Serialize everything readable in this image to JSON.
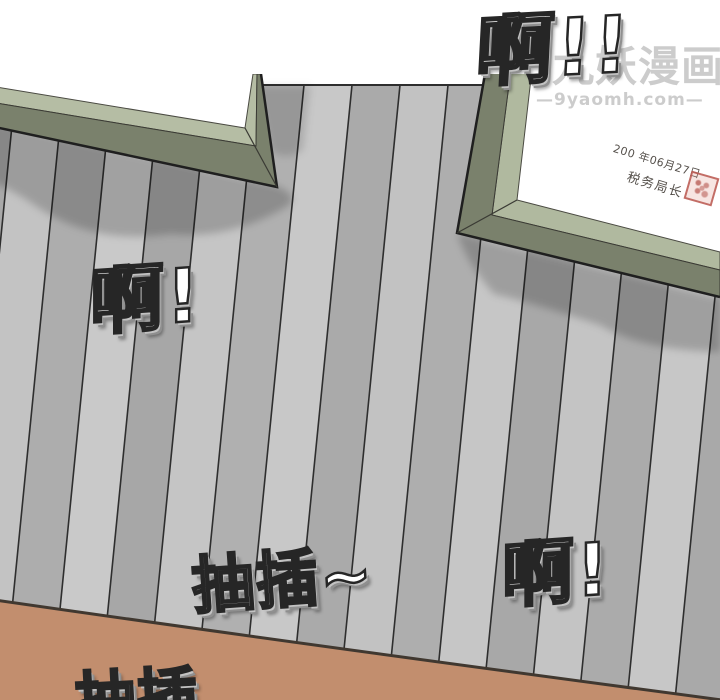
{
  "panel": {
    "sfx": {
      "top": "啊!!",
      "left": "啊!",
      "bottom_right": "啊!",
      "thrust": "抽插~",
      "bottom_partial": "抽插"
    },
    "frame_document": {
      "date_line": "200 年06月27日",
      "signer_line": "税务局长"
    },
    "watermark": {
      "site_name": "九妖漫画",
      "site_url": "—9yaomh.com—"
    },
    "colors": {
      "frame_sage": "#b5bda4",
      "frame_olive": "#7a816c",
      "frame_outline": "#1f1f1f",
      "wall_light_plank": "#c7c7c7",
      "wall_mid_plank": "#a9a9a9",
      "plank_line": "#2e2e2e",
      "floor_brown": "#c28e6e",
      "floor_edge_line": "#403830",
      "seal_red": "#b4544c",
      "watermark_gray": "#d2d2d2",
      "sfx_fill": "#ffffff",
      "sfx_outline": "#262626"
    }
  }
}
